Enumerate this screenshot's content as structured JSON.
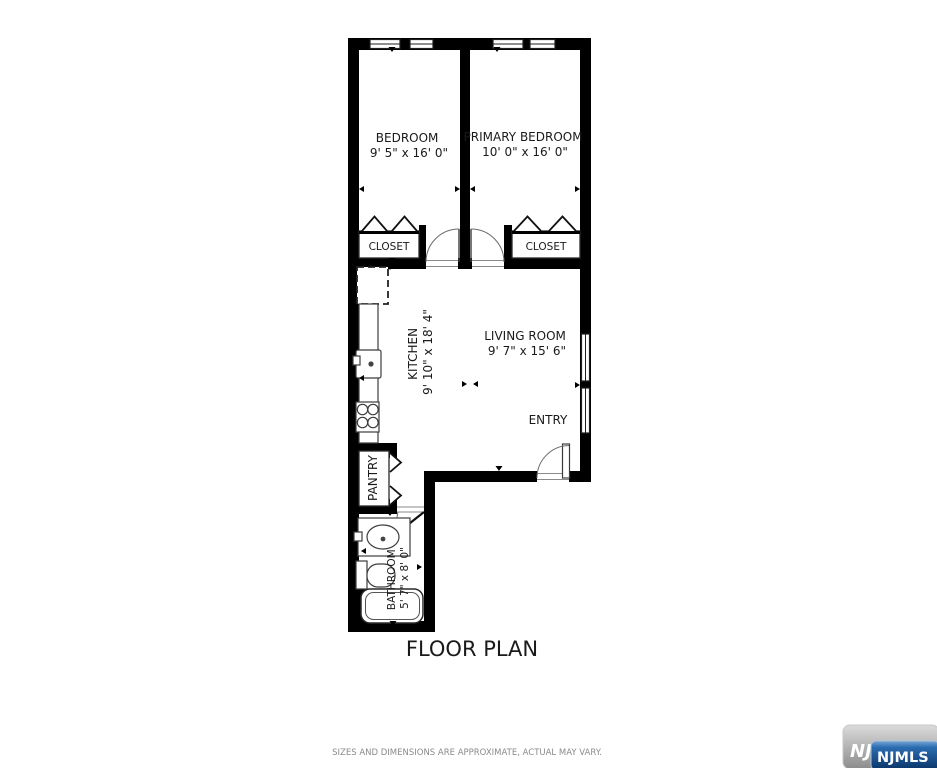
{
  "title": "FLOOR PLAN",
  "disclaimer": "SIZES AND DIMENSIONS ARE APPROXIMATE, ACTUAL MAY VARY.",
  "rooms": {
    "bedroom": {
      "name": "BEDROOM",
      "dims": "9' 5\" x 16' 0\""
    },
    "primary_bedroom": {
      "name": "PRIMARY BEDROOM",
      "dims": "10' 0\" x 16' 0\""
    },
    "closet_left": {
      "name": "CLOSET"
    },
    "closet_right": {
      "name": "CLOSET"
    },
    "kitchen": {
      "name": "KITCHEN",
      "dims": "9' 10\" x 18' 4\""
    },
    "living_room": {
      "name": "LIVING ROOM",
      "dims": "9' 7\" x 15' 6\""
    },
    "entry": {
      "name": "ENTRY"
    },
    "pantry": {
      "name": "PANTRY"
    },
    "bathroom": {
      "name": "BATHROOM",
      "dims": "5' 7\" x 8' 0\""
    }
  },
  "logo": {
    "back_text": "NJ",
    "front_text": "NJMLS"
  },
  "colors": {
    "wall": "#000000",
    "label": "#1a1a1a",
    "disclaimer": "#8a8a8a",
    "logo_blue": "#12508f",
    "logo_gray": "#a6a6a6"
  }
}
